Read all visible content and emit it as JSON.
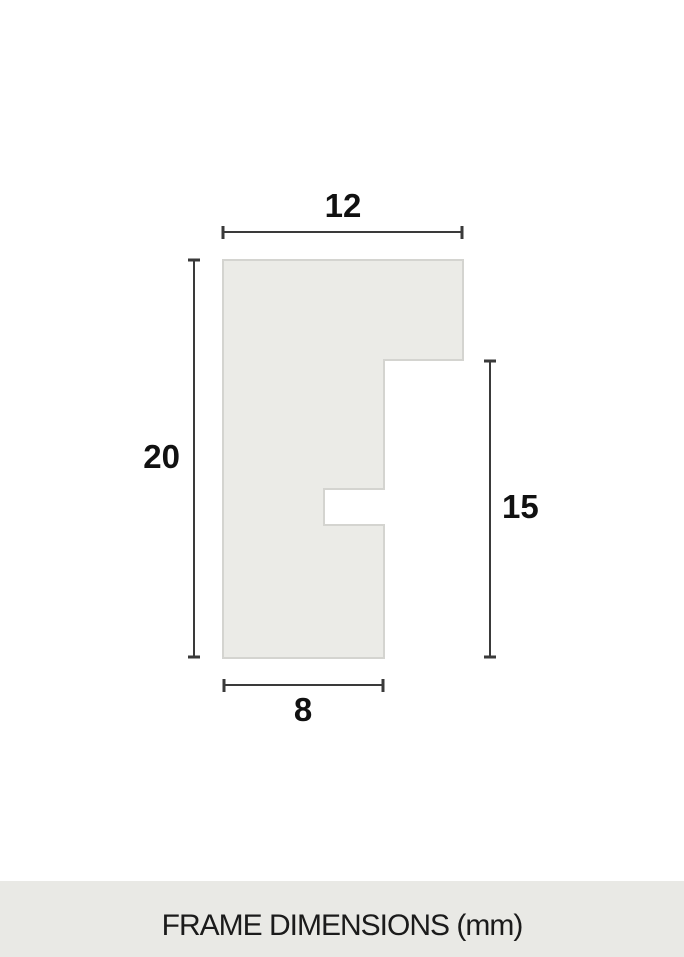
{
  "diagram": {
    "type": "frame-profile-cross-section",
    "unit": "mm",
    "dimensions": [
      {
        "id": "top-width",
        "side": "top",
        "value": "12"
      },
      {
        "id": "left-height",
        "side": "left",
        "value": "20"
      },
      {
        "id": "right-height",
        "side": "right",
        "value": "15"
      },
      {
        "id": "bottom-width",
        "side": "bottom",
        "value": "8"
      }
    ],
    "colors": {
      "shape_fill": "#EBEBE7",
      "shape_stroke": "#D4D4D0",
      "dimension_line": "#3A3A3A",
      "label_text": "#111111"
    }
  },
  "footer": {
    "label": "FRAME DIMENSIONS (mm)",
    "background": "#E9E9E5",
    "text_color": "#1B1B1B"
  }
}
